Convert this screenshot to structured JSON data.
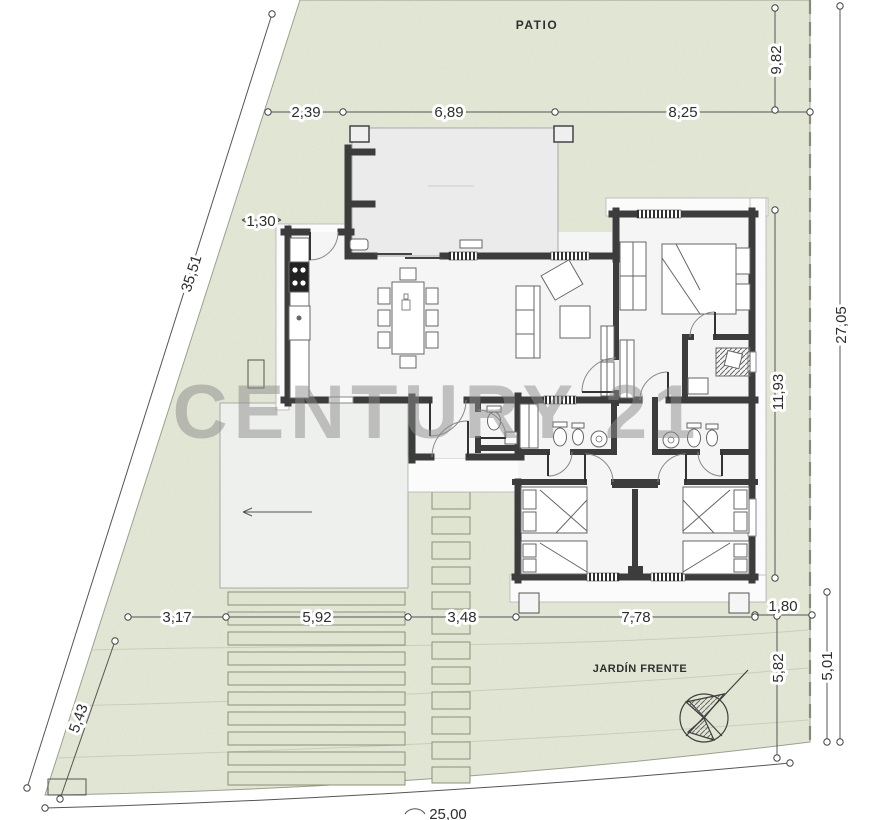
{
  "drawing": {
    "type": "architectural site and floor plan",
    "labels": {
      "patio": "PATIO",
      "jardin_frente": "JARDÍN FRENTE",
      "watermark": "CENTURY 21"
    },
    "dimensions": {
      "top_left": "2,39",
      "top_middle": "6,89",
      "top_right": "8,25",
      "right_top": "9,82",
      "right_middle": "11,93",
      "right_total": "27,05",
      "left_boundary": "35,51",
      "side_setback": "1,30",
      "bottom_seg1": "3,17",
      "bottom_seg2": "5,92",
      "bottom_seg3": "3,48",
      "bottom_seg4": "7,78",
      "bottom_seg5": "1,80",
      "front_left": "5,43",
      "front_depth": "5,82",
      "front_right": "5,01",
      "frontage_total": "25,00"
    },
    "colors": {
      "lawn": "#e4e8d7",
      "walls": "#3c3c3c",
      "terrace": "#ebebeb",
      "dimension_lines": "#555555",
      "watermark": "#8d8d8d"
    },
    "icons": {
      "compass": "compass-north-icon"
    }
  }
}
